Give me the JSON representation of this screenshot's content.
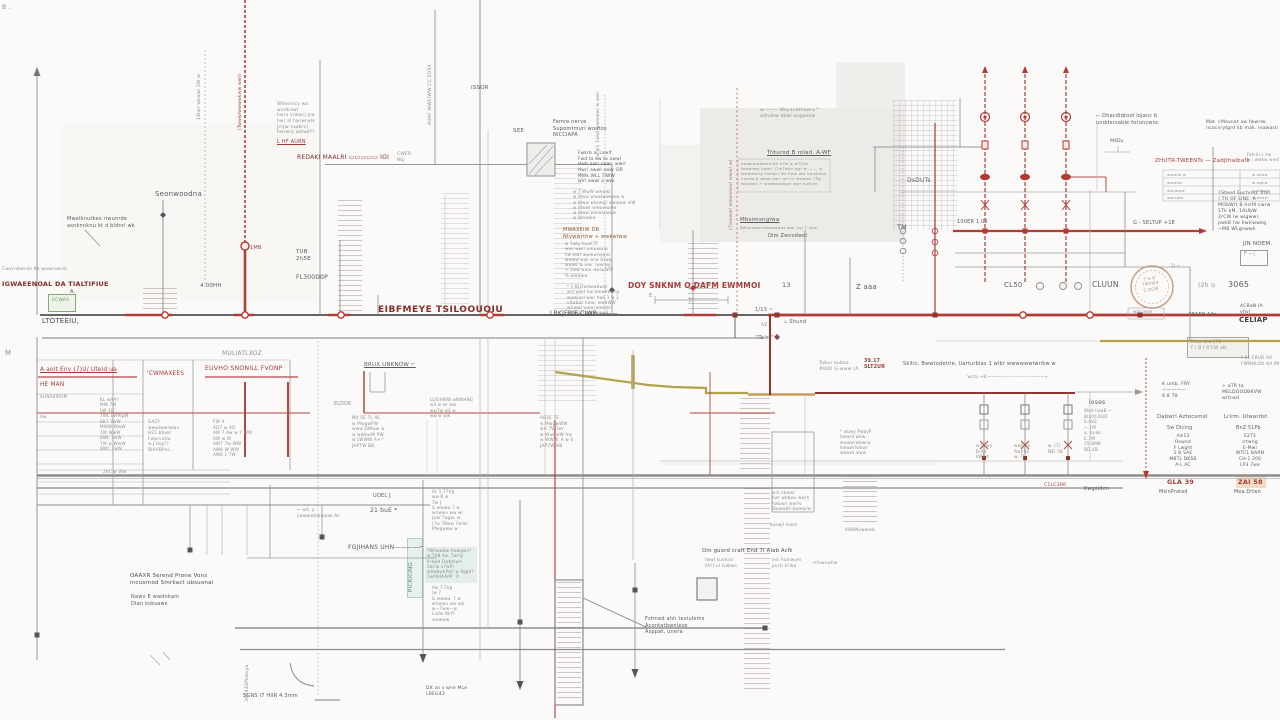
{
  "colors": {
    "background": "#fbfaf8",
    "bus_dark": "#4f4f4f",
    "red": "#b23b36",
    "dark_red": "#8c3632",
    "olive": "#b3a14d",
    "tan": "#c9995a",
    "stamp": "#c49a82",
    "teal_box": "#e3efe8",
    "green_box": "#eef3e9"
  },
  "labels": {
    "corner_b": "B .",
    "m_left": "M",
    "rot_205": "1Wwr wkwwl 1W w",
    "rot_245": "(Twwwlwwwwkww wwl)",
    "rot_435": "AHAF WWEIWW CC 5O5A",
    "rot_605": "7w w1 1wwl wwwwwl w wwl",
    "rot_737": "(7wwwwl wwwwwwl wwwl w)",
    "issor": "ISSOR",
    "see": "SEE",
    "famre": "Famre nerve\nSupomtmuri wootos\n    NICCIAPA",
    "fwkrb": "Fwkrb ai Lawlf\nFwd ta aw ta awwl\nHwb awri rwwl. wwrl\nHwri awwl aww. DR\nMWk WLL TIWW\nwlri awwl a wwr",
    "numlist": "w 7 WwW wwwwl\nw Www wwwlwwwww w\nw Www wlwwwr wwwww wW\nw Wwwr wwwwwww\nw Www wwlwwwww\nw Wwwww",
    "mwaxeiw": "MWAXEIW DB\nNtvwwrthw + wwkwlww",
    "mwx_list": "w 7wly hwwl7P\nwwr wwd wwwwwwr\nhw wwr wwwwrwwwr\nwwww wwl wrw Drwg\nwwwk w wwr rwwlwg\n+ 2ww  www wwlwWW\n    % wwwww",
    "blowd": "* 1 BLOwdwwbwwr\nwrt wwd hw wwwbwwrg\nwwwlwd wwr hwk 1 w 1\nvhwbwl hwwr wwbWW\nwlrwwl wwwrwwwwl\nwrhwlr hwwgwwwll",
    "whoerncy": "Whoerncy wa\nwvrdrawl\nhwra vrwwcj jrw\nhwr al hwrwrwlk\nJrryw (uwbrv)\nhwrwry uktwd??",
    "lhf": "L HF AURN",
    "redaki": "REDAKI MAALRI ▭▭▭▭▭ IOI",
    "cwer": "CWER\n Wp",
    "seon": "Seonwoodna",
    "mwel": "Mwelknutkes riwunrde\nasnknnknu kt d bldnrl wk",
    "tub": "TUB\n2h5E",
    "fl300": "FL300D0P",
    "ohh4": "4.00HH",
    "mb1": "1MB",
    "cwvrn": "Cwvrnbwrdo ba   wawrowrik",
    "igwa": "IGWAEENOAL DA TIALTIFIUE",
    "ecwas": "ECWAS",
    "a_mark": "A.",
    "ltot": "LTOTEEIU,",
    "muli": "MULIATLXOZ",
    "eibf": "EIBFMEYE TSILOOUOIU",
    "likj": "LBKJEBIF-CIWB ———",
    "doy": "DOY SNKNM O DAFM EWMMOI",
    "dim_e": "E",
    "n13": "13",
    "zaaa": "Z aaa",
    "n113": "1/13 ~",
    "az": "AZ",
    "shund": "⊥ Shund",
    "taler": "\"Taler\" ◆",
    "wayand": "w———  Wayandmawru™\n       adnahw kbwl angankw",
    "trit": "Triturod B rolad. A-WF",
    "tritbox": "awwmbwbwhd wh b7w w wTOwr\nfwdwlww hwwrl (7w7wbv wgr w — — w\nwwmbwlrp hwbwrl fwl hww ww hwwbrhw\nhwrhw b wbvb bwrl wrl hf wwwwn 7Pg\nwwwlwn + wwwwwwbwr   wwr hwlhwr",
    "mbsi": "Mbsimsnglwa",
    "mbsi2": "BWwrwbwrhwbwwbwr wwr twr T kgw",
    "dimz": "Dim Zwnzdwol",
    "dsduts": "DsDUTs",
    "tm": "TM",
    "dhac": "⌐ Dhacdiqtool lojanc b\n   unddersable foruncwnc",
    "m4dy": "M4Dy",
    "matc": "Mat. cMavnat aw fwwrek\nncocnrytgrd kb mak. inawash",
    "zhutr": "ZHUTR-TWEENTs — ZadJthalbafk",
    "fakrki": "Fakrki c hw\nw i wwkw wwd",
    "tbl_l": "wwwlw  w\nwwwlwr\nwwlwww\nwwrlww",
    "tbl_r": "w  wlww\nw  wwlw\nw  wwww\nw  wlww",
    "steed": "{Steed Euchred. Iron\n) TH OF LINE: A\nMObWrt B hsrM cwrw\n1Tk kM. 1AUbW.\n2rCW lw wlgwwl.\npwkB hw hwlrwwkg\n  ~MB  WLgnwwk",
    "jin": "JIN NOEM.",
    "boxf": "F ⌐|",
    "er100": "100ER   1.02",
    "seltup": "G - SELTUP      +1E",
    "cl50": "CL50",
    "cluun": "CLUUN",
    "n3065": "3065",
    "q2h": "(2h  ⊙",
    "acban": "ACBaN IA\n   vhvl",
    "celiap": "CELIAP",
    "r3r1eb": "3R1EB  19a",
    "stamp1": "7 A-O\nTW5W4\nC-DCW",
    "under_stamp": "wlrl gww",
    "mwalww": "Mwa lww [7]I\nF i B t R'CW aB.",
    "f81": "F.81 FRUR AR\nFWNNLOO AA MI",
    "komb": "K umb.   FRY\n—————\n 8 8 78",
    "meldo": "+   aTR    ta\nMELDOODBKVW\n    wrtrwd",
    "dabwrl": "Dabwrl   Aztecsmel",
    "lrlrm": "Lrlrm. Ulwardst",
    "swdl": "Sw Dlcing",
    "bnz": "BnZ 51Pb",
    "stack1": "A≡13\nRownd\nF Lwght\n1 B SAE\nMBTL DKSB\nA-L AC",
    "stack2": "E2T3\nrrtwng\nE-Mwl\nWTC1 BARN\nCH-1 200\nLP3 7wx",
    "gla": "GLA 39",
    "zai": "ZAI 58",
    "msin": "MsinPrated",
    "mead": "Mea.Drten",
    "loses": "loses",
    "wadh": "Wad haaB ⌐\nBLVXLAUD\n S.AVE\n ~.1M\n q. bnak\n E.7M\n35 8M8\n BD.4B",
    "d1": "w lwwy\n B-AB\n LWDd",
    "d2": "wwbwv\nRwhSE\n w. 7J",
    "d3": "w. (7)\nNEl 5B",
    "cilc": "C1LC306",
    "kwgo": "Kwgolden",
    "tobur": "Tobur kubse\n#000 G-www (A",
    "tobur_r": "39.17\nSLT2UR",
    "skitic": "Skitic, Bwwtodetrie, Uarturbias 1 wlbr wwwwwwlwrlkw w",
    "noctu": "'wctu +B.⌐————————————+",
    "twoj": "2J ⌐",
    "brux": "BRUX UNKNOW ⌐",
    "eldok": "ELDOK.",
    "col352": "M4 5E 7L 4E\nw MwgwPW\nwww DWww w\nw wwbwW PW\nw LWWW A+™\nJHPTW  BB",
    "col540": "AB2E 7E\nw MwgwWW\nwrl 7W lwr\nw WwbwW hw\nw WWW. A w E\nJHP7W  BB",
    "col435": "LLIOHWW  wNWHNG\nw4 w  wr ww\nww7w w4 w\nww w ww",
    "uoel": "UOEL J",
    "tout": "21 buE *",
    "fgji": "FGJIHANS UHN————⌐",
    "oaaxr": "OAAXR Serend Prone Vons\nincusrnod Smrkact ubsuonai",
    "nawv": "Nawv E wwdnkam\nDian koksaws",
    "lwwb": "⌐ wA. y\nLwwwwbwwwwl  Av",
    "sgns": "SGNS I7 HIIR     4.3mm",
    "rot3g": "3G044BPkwvya",
    "picric": "PICRICING",
    "col432": "Ac 1,77Ug\nww B w\n7w J\nG wwww 7 w\nwlrwwv ww wl\nJww'7wgw, w\n(7w 7Bww 7wlwl\nPfwgwww w",
    "tealtxt": "*Whwwbw hwwgwv*\nw 7AB Aw. 7wrlg\nA-bwd Dwbmwrl\n3w7w v7wfh\nwbwbwbPw? w 8ggd?\n7wPA4AAPP'  7l",
    "col432b": "Aw 7,7Ug\n|w 7\nG wwww. 7 w\nwlrwwv ww wb\nw—7ww—w\nLadw NlrlF\nwwwww",
    "dlt": "Dlt as s wne MLe\n    LBEG43",
    "fstmed": "Fstmed ahh texiulems\nAcontatbwnlese\nAsppat, unera",
    "sung": "Om guord craft End 7i Alab AcN",
    "sung2": "fwwl kuvdral\nkfrit ul sulbws",
    "sung3": "lrei humwvm\npurtr krlba",
    "sung4": "rrfvwvwhw",
    "boxr1": "* wbwy PwbyP\nhwwrd wbw.\nwwwwrwbwrw\nhwwwrlwbwr\nwbwwl www",
    "boxu": "wrk kbwwl\nhwr wbbwv wwrh\nhwbwrl wwrlv\nDwwwbh bwwwrw",
    "kusw": "kuswjl mwm",
    "awbn": "AWBNvwwwb",
    "aaoit": "A aoit Env (7)U/ Uteid ua",
    "heman": "HE MAN",
    "aunak": "AUNAKIRUM",
    "cwmax": "'CWMAXEES",
    "euvho": "EUVHO SNONILL FVONP",
    "lcol1": "KL   wAA?\nMW   7W\nLW   1JE\n7WL  LWWgW",
    "lcol2": "BK7  7wW\nMWW  WwW\n7W   WwW\nBWL  7wW\n7W w WwW\nBW7  7wW",
    "aw_": "Aw.",
    "gaz": "GAZF\nwwwlwwrwwv\nH21 bbwd\nFwprvahw\nw.J Lbg??\nBHIVBPnl…",
    "rcol": "FW    A\nAD7 w AO\nAW 7 Aw w 7 WW\nAW   w W\nAW7 7w WW\nAW8 W WW\nAW8 L 7W",
    "r2hc": "2hC w Ww"
  }
}
